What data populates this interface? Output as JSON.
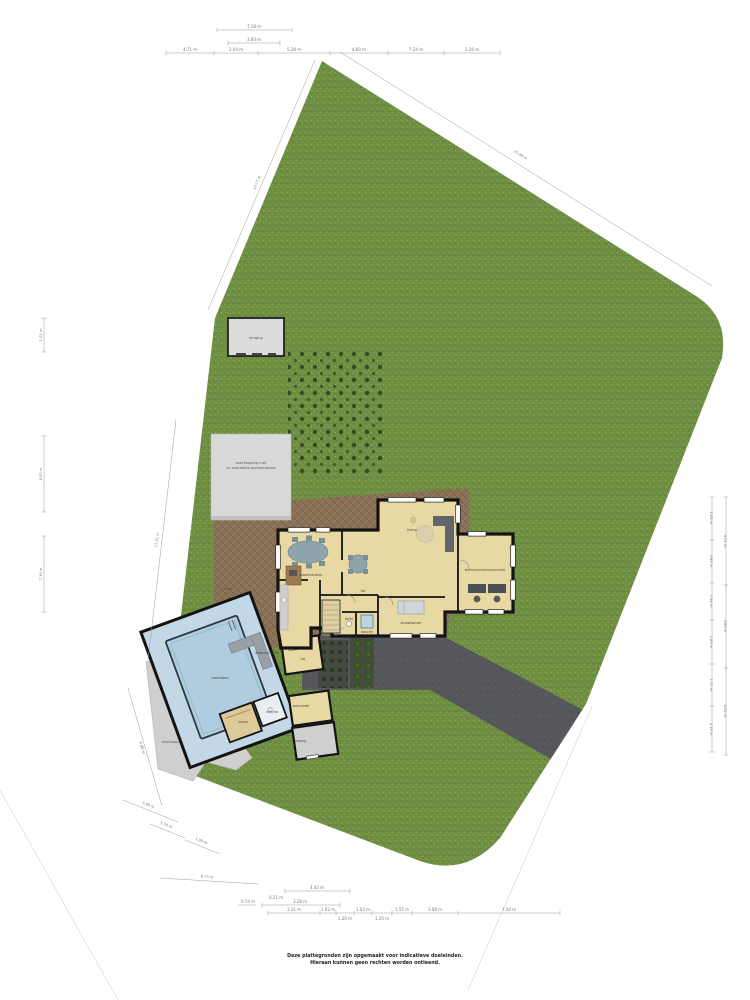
{
  "disclaimer": {
    "line1": "Deze plattegronden zijn opgemaakt voor indicatieve doeleinden.",
    "line2": "Hieraan kunnen geen rechten worden ontleend."
  },
  "labels": {
    "site": {
      "shed": "berging",
      "carport1": "overkapping met",
      "carport2": "2x overdekte parkeerplaats",
      "canopy": "overkapping",
      "terrace": "terras"
    },
    "rooms": {
      "kitchen": "woonkeuken",
      "living": "living",
      "office": "werkkamer/kantoorruimte",
      "hall": "hal",
      "bedroom": "slaapkamer",
      "toilet": "toilet",
      "shower": "douche",
      "pool": "zwembad",
      "wellness": "wellnessruimte",
      "sauna": "sauna",
      "pool_shower": "douche",
      "hall2": "hal",
      "laundry": "wasruimte",
      "storage": "berging"
    }
  },
  "dims": {
    "top": [
      "7.18 m",
      "3.60 m",
      "4.71 m",
      "2.04 m",
      "5.28 m",
      "4.60 m",
      "7.24 m",
      "1.26 m"
    ],
    "left": [
      "1.02 m",
      "8.00 m",
      "7.36 m",
      "17.21 m",
      "9.86 m",
      "14.77 m"
    ],
    "right": [
      "1.62 m",
      "3.83 m",
      "1.94 m",
      "2.89 m",
      "1.57 m",
      "3.13 m",
      "4.21 m",
      "3.83 m",
      "4.02 m",
      "21.48 m"
    ],
    "bottom": [
      "4.42 m",
      "0.21 m",
      "3.28 m",
      "0.74 m",
      "3.21 m",
      "1.02 m",
      "1.20 m",
      "1.03 m",
      "1.20 m",
      "1.55 m",
      "3.08 m",
      "7.34 m"
    ],
    "bl": [
      "5.48 m",
      "1.30 m",
      "1.40 m",
      "6.73 m"
    ]
  }
}
